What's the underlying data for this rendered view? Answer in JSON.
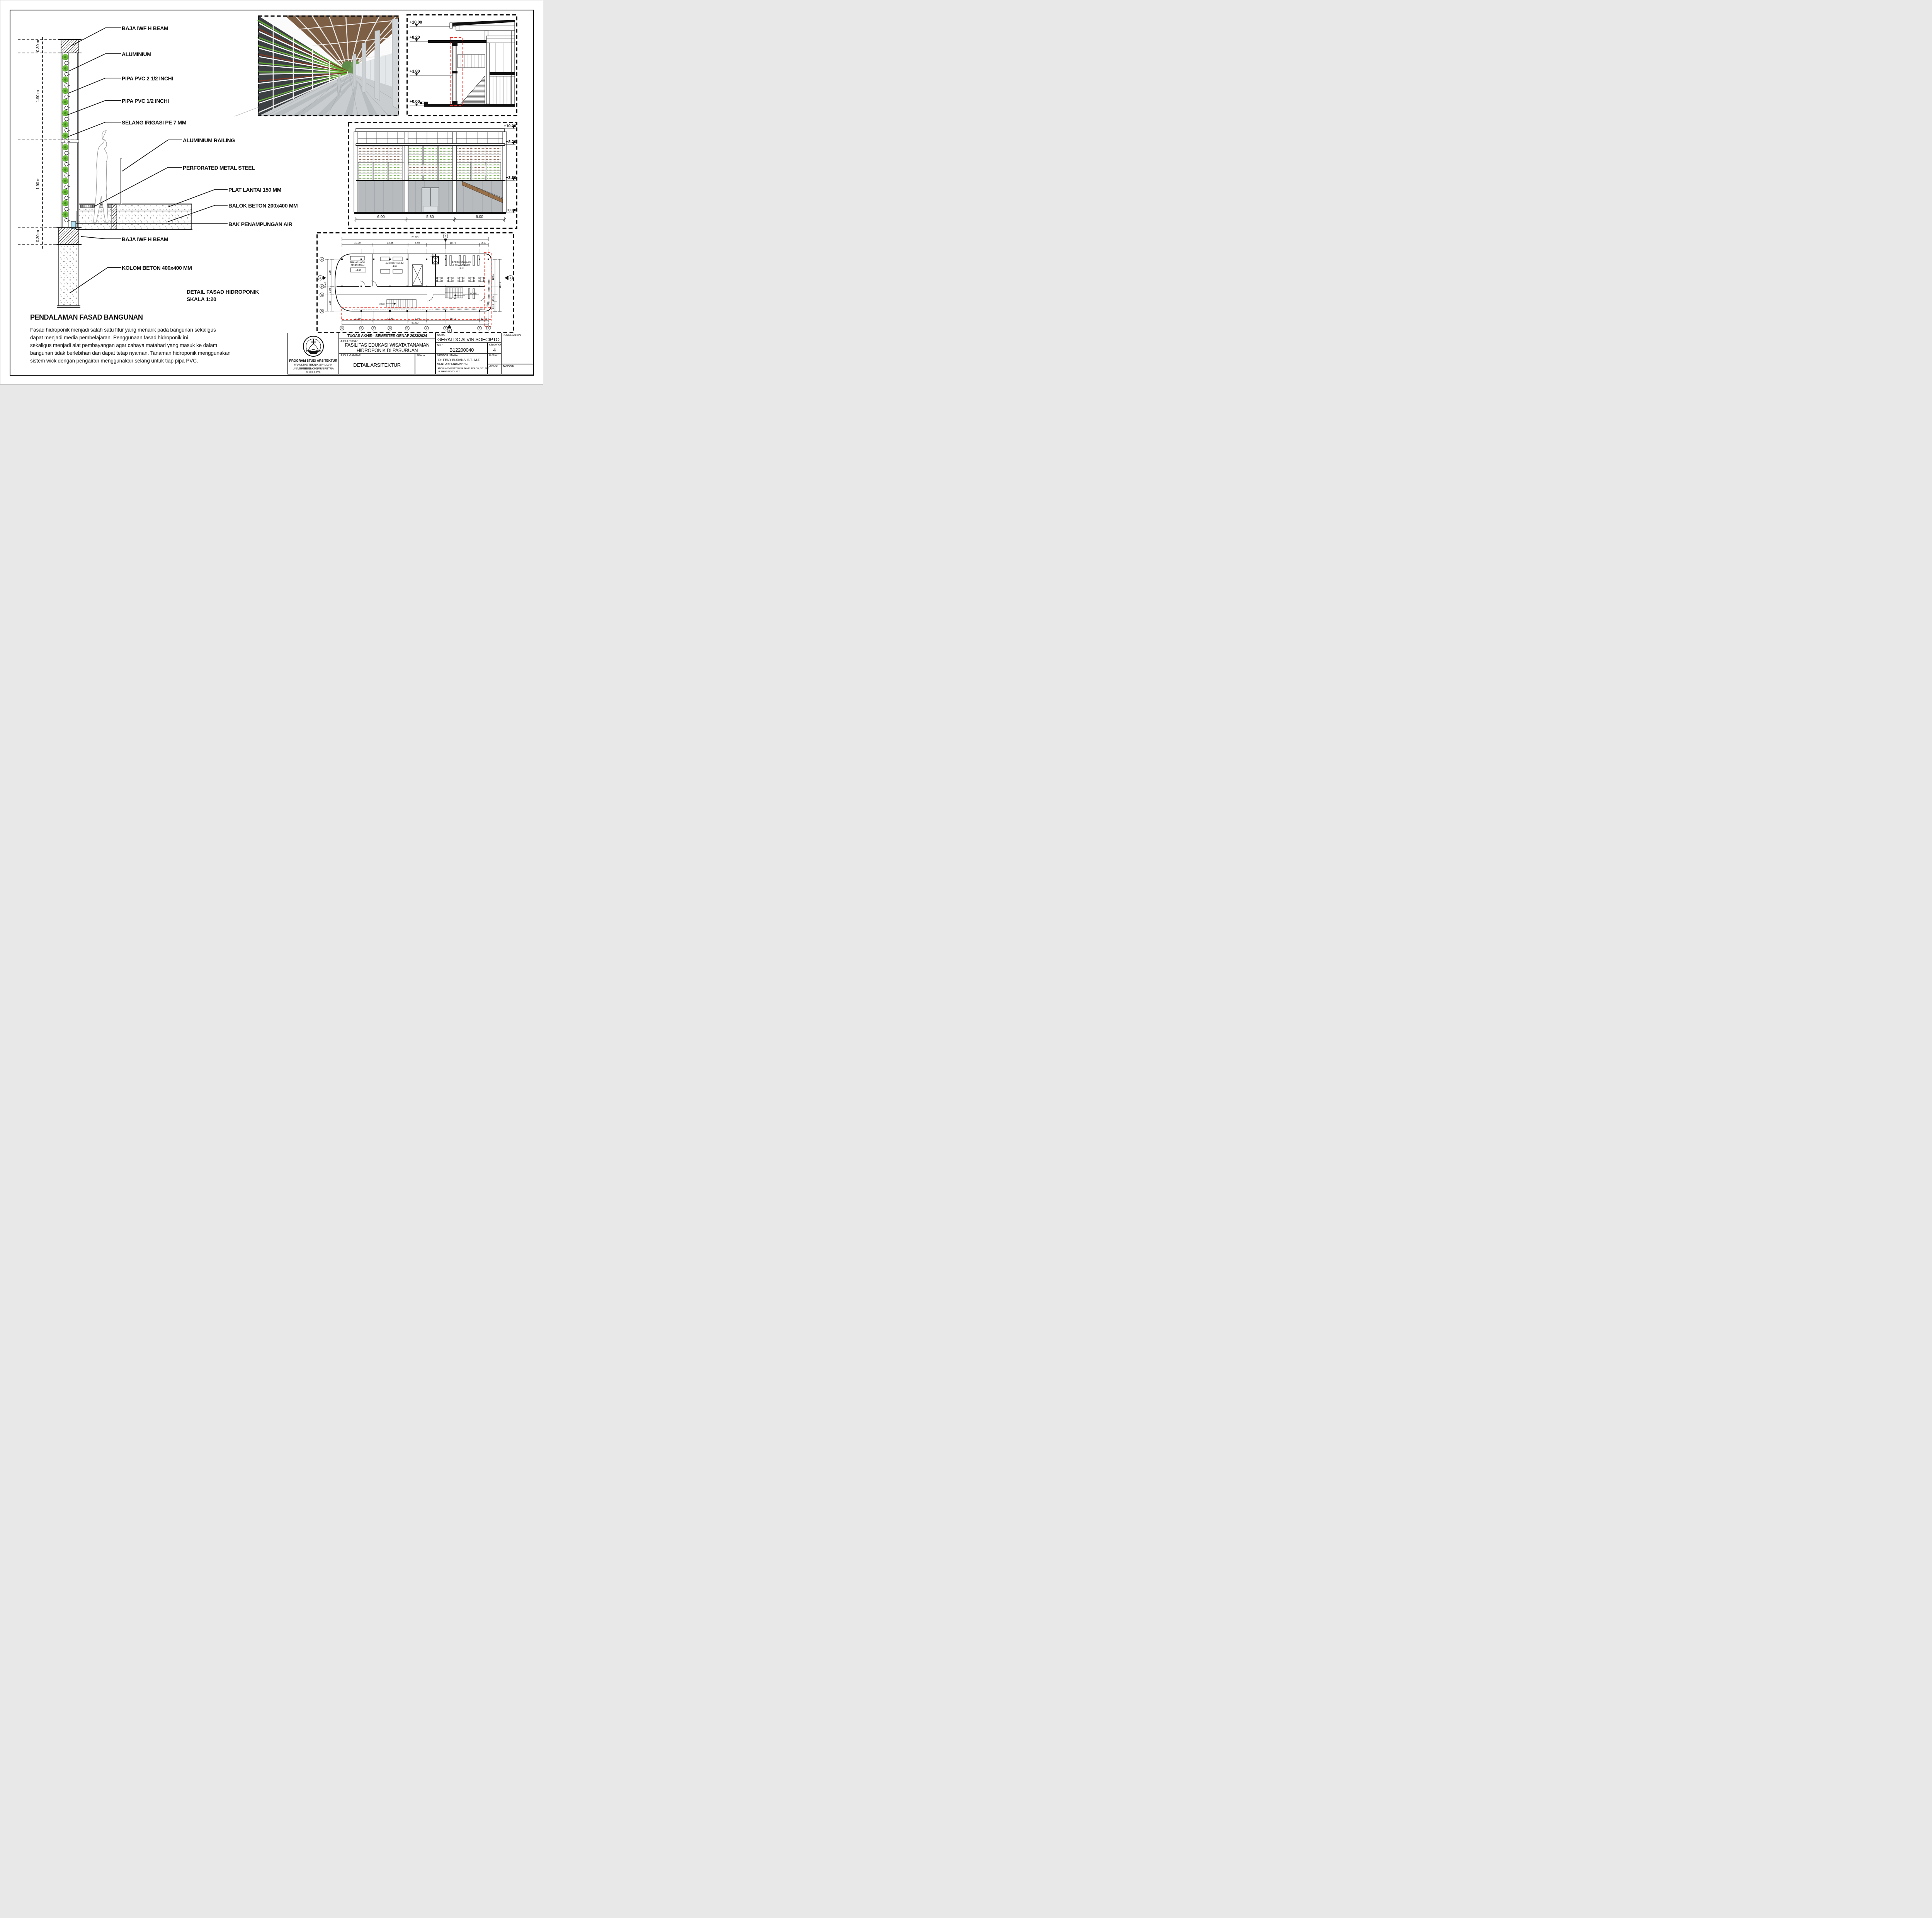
{
  "detail": {
    "labels": [
      "BAJA IWF H BEAM",
      "ALUMINIUM",
      "PIPA PVC 2 1/2 INCHI",
      "PIPA PVC 1/2 INCHI",
      "SELANG IRIGASI PE 7 MM",
      "ALUMINIUM RAILING",
      "PERFORATED METAL STEEL",
      "PLAT LANTAI 150 MM",
      "BALOK BETON 200x400 MM",
      "BAK PENAMPUNGAN AIR",
      "BAJA IWF H BEAM",
      "KOLOM BETON 400x400 MM"
    ],
    "dims": [
      "0.30 m",
      "1.90 m",
      "1.90 m",
      "0.30 m"
    ],
    "title_line1": "DETAIL FASAD HIDROPONIK",
    "title_line2": "SKALA 1:20"
  },
  "pendalaman": {
    "heading": "PENDALAMAN FASAD BANGUNAN",
    "lines": [
      "Fasad hidroponik menjadi salah satu fitur yang menarik pada bangunan sekaligus",
      "dapat menjadi media pembelajaran. Penggunaan fasad hidroponik ini",
      "sekaligus menjadi alat pembayangan agar cahaya matahari yang masuk ke dalam",
      "bangunan tidak berlebihan dan dapat tetap nyaman. Tanaman hidroponik menggunakan",
      "sistem wick dengan pengairan menggunakan selang untuk tiap pipa PVC."
    ]
  },
  "section": {
    "levels": [
      "+10.00",
      "+8.20",
      "+3.80",
      "+0.00"
    ]
  },
  "elevation": {
    "levels": [
      "+10.00",
      "+8.20",
      "+3.80",
      "+0.00"
    ],
    "dims": [
      "6.00",
      "5.80",
      "6.00"
    ]
  },
  "plan": {
    "dim_total": "51.50",
    "segs": [
      "10.90",
      "12.35",
      "6.40",
      "18.75",
      "3.10"
    ],
    "left_dims": [
      "9.60",
      "3.00",
      "5.80"
    ],
    "left_total": "18.40",
    "right_dims": [
      "12.60",
      "2.40",
      "3.40"
    ],
    "right_total": "18.40",
    "room1a": "RUANG HASIL",
    "room1b": "PENELITIAN",
    "room1c": "+4.65",
    "room2a": "LABORATORIUM",
    "room2b": "+4.65",
    "room3a": "PERPUSTAKAAN",
    "room3b": "& RUANG BACA",
    "room3c": "+4.65",
    "ahu_a": "AHU",
    "ahu_b": "+4.65",
    "down": "DOWN",
    "grid_cols": [
      "9",
      "8",
      "7",
      "6",
      "5",
      "4",
      "3",
      "2",
      "1"
    ],
    "grid_rows": [
      "A",
      "B",
      "C",
      "D"
    ],
    "mark_a": "A",
    "mark_b": "B"
  },
  "titleblock": {
    "header": "TUGAS AKHIR - SEMESTER GENAP 2023/2024",
    "judul_tugas_label": "JUDUL TUGAS",
    "judul_tugas_1": "FASILITAS EDUKASI WISATA TANAMAN",
    "judul_tugas_2": "HIDROPONIK DI PASURUAN",
    "judul_gambar_label": "JUDUL GAMBAR",
    "judul_gambar": "DETAIL ARSITEKTUR",
    "skala_label": "SKALA",
    "nama_label": "NAMA",
    "nama": "GERALDO ALVIN SOECIPTO",
    "nrp_label": "NRP",
    "nrp": "B12200040",
    "kelompok_label": "KELOMPOK",
    "kelompok": "4",
    "mentor_utama_label": "MENTOR UTAMA",
    "mentor_utama": "Dr. FENY ELSIANA, S.T., M.T.",
    "mentor_pendamping_label": "MENTOR PENDAMPING",
    "mentor_pendamping_1": "ANGELA CHRISTYSONIA TAMPUBOLON, S.T., M.T.",
    "mentor_pendamping_2": "IR. HANDINOTO, M.T.",
    "lembar_label": "LEMBAR",
    "jumlah_label": "JUMLAH",
    "tanggal_label": "TANGGAL",
    "pengesahan_label": "PENGESAHAN",
    "inst1": "PROGRAM STUDI ARSITEKTUR",
    "inst2": "FAKULTAS TEKNIK SIPIL DAN PERENCANAAN",
    "inst3": "UNIVERSITAS KRISTEN PETRA",
    "inst4": "SURABAYA"
  },
  "colors": {
    "accent_red": "#e8231a",
    "plant_green": "#53a12a",
    "plant_red": "#6b3226",
    "water": "#b5e3f5",
    "wood": "#7d5f46"
  }
}
